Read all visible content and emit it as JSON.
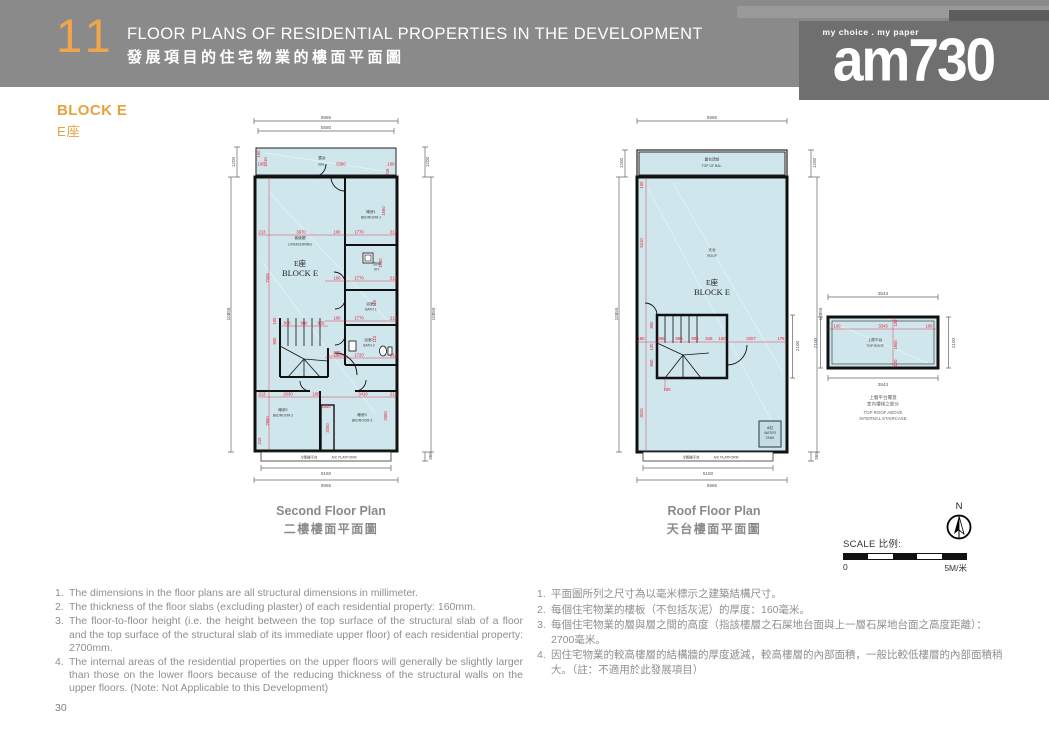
{
  "header": {
    "section_number": "11",
    "title_en": "FLOOR PLANS OF RESIDENTIAL PROPERTIES IN THE DEVELOPMENT",
    "title_zh": "發展項目的住宅物業的樓面平面圖",
    "logo_tagline": "my choice . my paper",
    "logo_name": "am730"
  },
  "block_label": {
    "en": "BLOCK E",
    "zh": "E座"
  },
  "colors": {
    "accent_orange": "#E9A13E",
    "header_gray": "#8A8A8A",
    "plan_fill": "#CFE6EC",
    "dimension_red": "#E8192C"
  },
  "plans": {
    "second": {
      "title_en": "Second Floor Plan",
      "title_zh": "二樓樓面平面圖",
      "rooms": {
        "bal_zh": "露台",
        "bal_en": "BAL.",
        "living_zh": "客飯廳",
        "living_en": "LIVING/DINING",
        "block_zh": "E座",
        "block_en": "BLOCK E",
        "bed1_zh": "睡房1",
        "bed1_en": "BEDROOM 1",
        "kit_zh": "廚房",
        "kit_en": "KIT.",
        "bath1_zh": "浴室1",
        "bath1_en": "BATH 1",
        "bath2_zh": "浴室2",
        "bath2_en": "BATH 2",
        "bed2_zh": "睡房2",
        "bed2_en": "BEDROOM 2",
        "bed3_zh": "睡房3",
        "bed3_en": "BEDROOM 3",
        "ac_zh": "冷氣機平台",
        "ac_en": "A/C PLATFORM"
      },
      "dims": {
        "outer_w": "5965",
        "inner_w": "5580",
        "bal_w": "5380",
        "bal_d": "1010",
        "side_top": "1200",
        "side_h": "10855",
        "d150": "150",
        "d215": "215",
        "d213": "213",
        "d212": "212",
        "d100": "100",
        "d110": "110",
        "living_w": "3670",
        "d1770": "1770",
        "kit_d": "1680",
        "bed1_d": "1660",
        "bath2_w": "1720",
        "d900": "900",
        "d960": "960",
        "left_h": "7345",
        "d870": "870",
        "bed2_w": "2030",
        "bed3_w": "3410",
        "d1650": "1650",
        "d2000": "2000",
        "d2950": "2950",
        "bot_inner": "5150",
        "bot_outer": "5965",
        "ac_d": "365"
      }
    },
    "roof": {
      "title_en": "Roof Floor Plan",
      "title_zh": "天台樓面平面圖",
      "rooms": {
        "topbal_zh": "露台頂部",
        "topbal_en": "TOP OF BAL.",
        "roof_zh": "天台",
        "roof_en": "ROOF",
        "block_zh": "E座",
        "block_en": "BLOCK E",
        "tank_zh": "水缸",
        "tank_en1": "WATER",
        "tank_en2": "TANK",
        "ac_zh": "冷氣機平台",
        "ac_en": "A/C PLATFORM"
      },
      "dims": {
        "outer_w": "5965",
        "side_top": "1200",
        "side_h": "10855",
        "stair_h": "2100",
        "d150": "150",
        "left_h": "5410",
        "s965": "965",
        "s960": "960",
        "s908": "908",
        "s518": "518",
        "s2207": "2207",
        "s175": "175",
        "v860": "860",
        "v120": "120",
        "d100": "100",
        "v3045": "3045",
        "bot_inner": "5150",
        "bot_outer": "5965",
        "ac_d": "365"
      }
    },
    "top_roof": {
      "label_zh": "上層平台",
      "label_en": "TOP ROOF",
      "caption_zh1": "上層平台覆蓋",
      "caption_zh2": "室內樓梯之部分",
      "caption_en1": "TOP ROOF ABOVE",
      "caption_en2": "INTERNAL STAIRCASE",
      "dims": {
        "w": "3543",
        "inner_w": "3343",
        "d100": "100",
        "inner_h": "1900",
        "side": "2100"
      }
    }
  },
  "compass": {
    "north_label": "N"
  },
  "scale_bar": {
    "label": "SCALE 比例:",
    "start": "0",
    "end": "5M/米"
  },
  "notes_en": [
    {
      "num": "1.",
      "text": "The dimensions in the floor plans are all structural dimensions in millimeter."
    },
    {
      "num": "2.",
      "text": "The thickness of the floor slabs (excluding plaster) of each residential property: 160mm."
    },
    {
      "num": "3.",
      "text": "The floor-to-floor height (i.e. the height between the top surface of the structural slab of a floor and the top surface of the structural slab of its immediate upper floor) of each residential property: 2700mm."
    },
    {
      "num": "4.",
      "text": "The internal areas of the residential properties on the upper floors will generally be slightly larger than those on the lower floors because of the reducing thickness of the structural walls on the upper floors. (Note: Not Applicable to this Development)"
    }
  ],
  "notes_zh": [
    {
      "num": "1.",
      "text": "平面圖所列之尺寸為以毫米標示之建築結構尺寸。"
    },
    {
      "num": "2.",
      "text": "每個住宅物業的樓板（不包括灰泥）的厚度：160毫米。"
    },
    {
      "num": "3.",
      "text": "每個住宅物業的層與層之間的高度（指該樓層之石屎地台面與上一層石屎地台面之高度距離）：2700毫米。"
    },
    {
      "num": "4.",
      "text": "因住宅物業的較高樓層的結構牆的厚度遞減，較高樓層的內部面積，一般比較低樓層的內部面積稍大。（註：不適用於此發展項目）"
    }
  ],
  "page_number": "30"
}
